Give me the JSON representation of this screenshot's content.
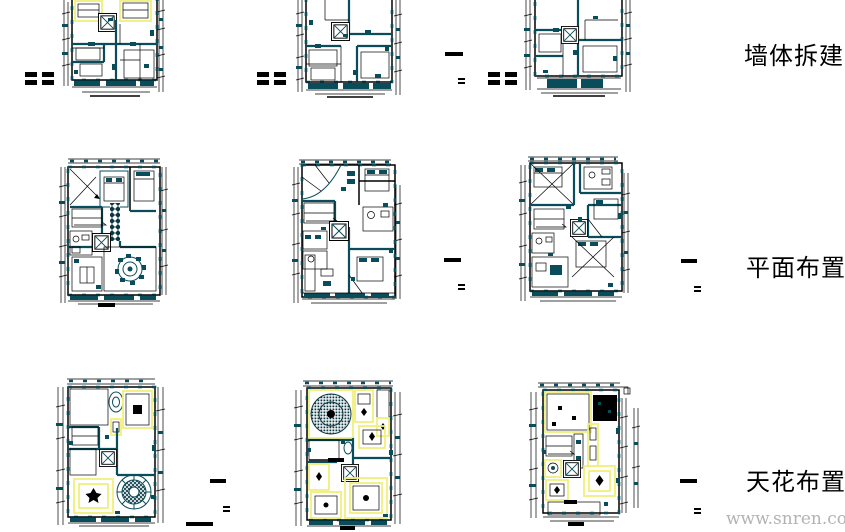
{
  "page": {
    "width": 845,
    "height": 532,
    "background": "#ffffff"
  },
  "row_labels": {
    "row1": "墙体拆建",
    "row2": "平面布置",
    "row3": "天花布置"
  },
  "watermark": {
    "text": "www.snren.com"
  },
  "colors": {
    "line_teal": "#0a4d5a",
    "dark_teal": "#0b3742",
    "line_black": "#000000",
    "highlight_yellow": "#f1ef7c",
    "watermark_gray": "#b3b3b3"
  }
}
